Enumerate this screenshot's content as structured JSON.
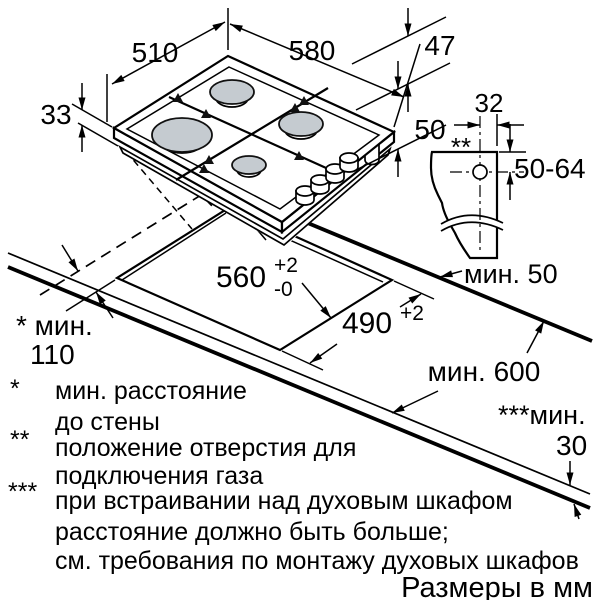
{
  "dims": {
    "depth_top": "510",
    "width_top": "580",
    "grate_height": "47",
    "body_height": "50",
    "rim_height": "33",
    "hole_offset": "32",
    "hole_range": "50-64",
    "hole_marker": "**",
    "cutout_width": "560",
    "cutout_width_sup": "+2",
    "cutout_width_sub": "-0",
    "cutout_depth": "490",
    "cutout_depth_sup": "+2",
    "min_side": "мин. 50",
    "min_worktop_depth": "мин. 600",
    "min_wall_1": "* мин.",
    "min_wall_2": "110",
    "min_thickness_1": "***мин.",
    "min_thickness_2": "30"
  },
  "footnotes": [
    {
      "marker": "*",
      "line1": "мин. расстояние",
      "line2": "до стены"
    },
    {
      "marker": "**",
      "line1": "положение отверстия для",
      "line2": "подключения газа"
    },
    {
      "marker": "***",
      "line1": "при встраивании над духовым шкафом",
      "line2": "расстояние должно быть больше;",
      "line3": "см. требования по монтажу духовых шкафов"
    }
  ],
  "units_note": "Размеры в мм"
}
